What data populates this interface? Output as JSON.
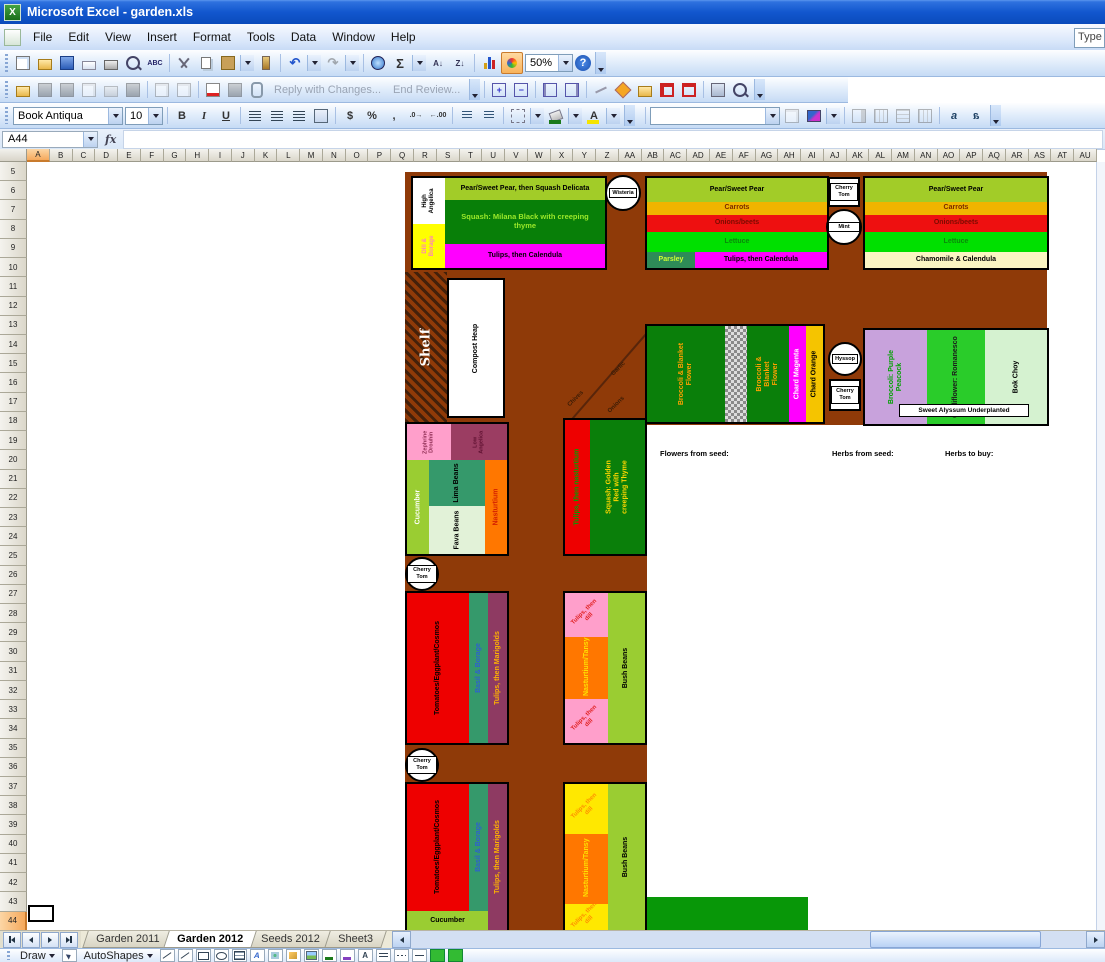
{
  "window": {
    "title": "Microsoft Excel - garden.xls",
    "help_box": "Type"
  },
  "menu": {
    "items": [
      "File",
      "Edit",
      "View",
      "Insert",
      "Format",
      "Tools",
      "Data",
      "Window",
      "Help"
    ]
  },
  "toolbar": {
    "zoom": "50%",
    "reply_with_changes": "Reply with Changes...",
    "end_review": "End Review...",
    "font_name": "Book Antiqua",
    "font_size": "10"
  },
  "icons": {
    "bold": "B",
    "italic": "I",
    "underline": "U",
    "sum": "Σ",
    "dollar": "$",
    "percent": "%",
    "comma": ",",
    "help": "?",
    "fx": "fx",
    "sort_az": "A↓",
    "sort_za": "Z↓",
    "abc": "ABC",
    "font_color_letter": "A",
    "aa": "a"
  },
  "formula_bar": {
    "name_box": "A44"
  },
  "grid": {
    "selected_cell": "A44",
    "selected_col": "A",
    "selected_row": 44,
    "columns": [
      "A",
      "B",
      "C",
      "D",
      "E",
      "F",
      "G",
      "H",
      "I",
      "J",
      "K",
      "L",
      "M",
      "N",
      "O",
      "P",
      "Q",
      "R",
      "S",
      "T",
      "U",
      "V",
      "W",
      "X",
      "Y",
      "Z",
      "AA",
      "AB",
      "AC",
      "AD",
      "AE",
      "AF",
      "AG",
      "AH",
      "AI",
      "AJ",
      "AK",
      "AL",
      "AM",
      "AN",
      "AO",
      "AP",
      "AQ",
      "AR",
      "AS",
      "AT",
      "AU"
    ],
    "rows": [
      5,
      6,
      7,
      8,
      9,
      10,
      11,
      12,
      13,
      14,
      15,
      16,
      17,
      18,
      19,
      20,
      21,
      22,
      23,
      24,
      25,
      26,
      27,
      28,
      29,
      30,
      31,
      32,
      33,
      34,
      35,
      36,
      37,
      38,
      39,
      40,
      41,
      42,
      43,
      44
    ]
  },
  "sheet_tabs": {
    "tabs": [
      "Garden 2011",
      "Garden 2012",
      "Seeds 2012",
      "Sheet3"
    ],
    "active": "Garden 2012"
  },
  "drawing": {
    "draw": "Draw",
    "autoshapes": "AutoShapes"
  },
  "colors": {
    "path_brown": "#8F3A08",
    "squash_green": "#087F08",
    "band_yellowgreen": "#A2CC28",
    "magenta": "#FF00FF",
    "carrot_gold": "#F0B400",
    "onion_red": "#EE1010",
    "lettuce_green": "#00E000",
    "parsley_seagreen": "#2E8B57",
    "chamomile": "#FAF5C2",
    "broccoli_purple": "#C8A2DC",
    "cauliflower_green": "#2ACC2A",
    "bokchoy_pale": "#D5F2D0",
    "pink": "#FF9FCB",
    "maroon": "#9B3D62",
    "cucumber_green": "#9ACD32",
    "lima_teal": "#35996B",
    "fava_pale": "#E2F2D8",
    "nasturtium_orange": "#FF7700",
    "tomato_red": "#EE0000",
    "marigold_purple": "#8E3A62",
    "dill_yellow": "#FFE800",
    "title_blue": "#1257CE"
  },
  "garden": {
    "bed_nw": {
      "side_top": "High Angelica",
      "side_bottom": "Dill & Borage",
      "row1": "Pear/Sweet Pear, then Squash Delicata",
      "main": "Squash: Milana Black with creeping thyme",
      "row3": "Tulips, then Calendula"
    },
    "bed_n": {
      "row1": "Pear/Sweet Pear",
      "row2": "Carrots",
      "row3": "Onions/beets",
      "row4": "Lettuce",
      "parsley": "Parsley",
      "row5": "Tulips, then Calendula"
    },
    "bed_ne": {
      "row1": "Pear/Sweet Pear",
      "row2": "Carrots",
      "row3": "Onions/beets",
      "row4": "Lettuce",
      "row5": "Chamomile & Calendula"
    },
    "shelf": "Shelf",
    "compost": "Compost Heap",
    "diagonal": {
      "chives": "Chives",
      "garlic": "Garlic",
      "onions": "Onions"
    },
    "bed_c": {
      "col1": "Broccoli & Blanket Flower",
      "col2": "Broccoli & Blanket Flower",
      "col3": "Chard Magenta",
      "col4": "Chard Orange"
    },
    "bed_e": {
      "col1": "Broccoli: Purple Peacock",
      "col2": "Cauliflower: Romanesco",
      "col3": "Bok Choy",
      "note": "Sweet Alyssum Underplanted"
    },
    "notes": {
      "flowers": "Flowers from seed:",
      "herbs_seed": "Herbs from seed:",
      "herbs_buy": "Herbs to buy:"
    },
    "bed_w2": {
      "rose": "Zephrine Drouhin",
      "angelica": "Low Angelica",
      "cucumber": "Cucumber",
      "lima": "Lima Beans",
      "fava": "Fava Beans",
      "nasturtium": "Nasturtium"
    },
    "bed_m1": {
      "col1": "Tulips, then nasturtium",
      "col2": "Squash: Golden Red with creeping Thyme"
    },
    "bed_w3": {
      "tomatoes": "Tomatoes/Eggplant/Cosmos",
      "basil": "Basil & Borage",
      "tulips": "Tulips, then Marigolds"
    },
    "bed_m2": {
      "top": "Tulips, then dill",
      "mid": "Nasturtium/Tansy",
      "bottom": "Tulips, then dill",
      "beans": "Bush Beans"
    },
    "bed_w4": {
      "tomatoes": "Tomatoes/Eggplant/Cosmos",
      "basil": "Basil & Borage",
      "tulips": "Tulips, then Marigolds",
      "cucumber": "Cucumber"
    },
    "bed_m3": {
      "top": "Tulips, then dill",
      "mid": "Nasturtium/Tansy",
      "bottom": "Tulips, then dill",
      "beans": "Bush Beans"
    },
    "markers": {
      "wisteria": "Wisteria",
      "cherry_tom": "Cherry Tom",
      "mint": "Mint",
      "hyssop": "Hyssop"
    }
  }
}
